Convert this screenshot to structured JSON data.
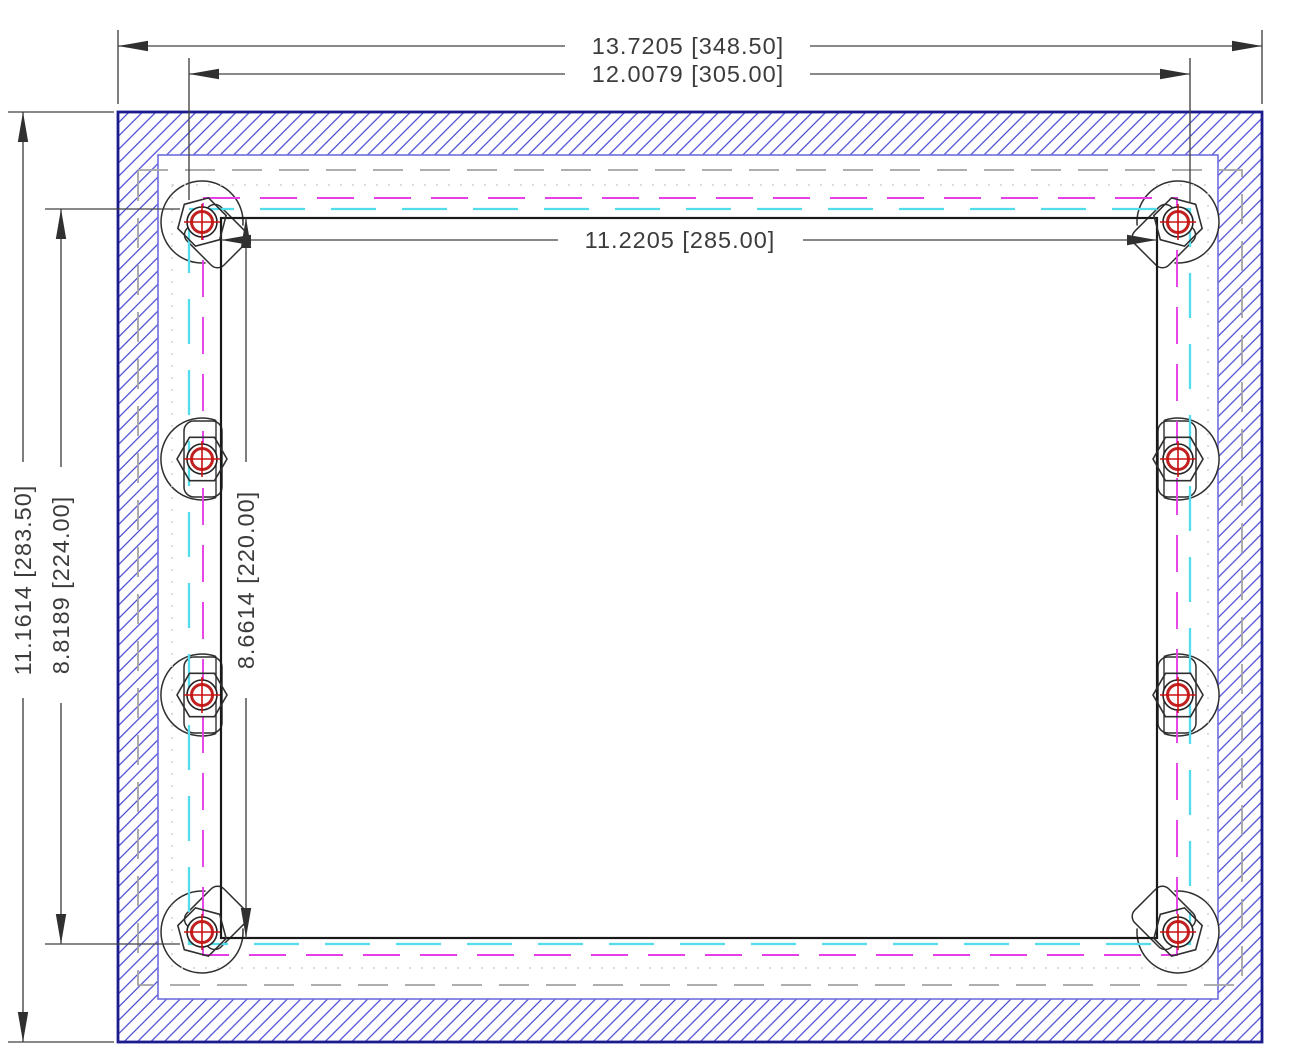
{
  "drawing": {
    "kind": "panel-mounting-cutout-cad-drawing",
    "stud_count": 8,
    "dims": {
      "overall_width": "13.7205 [348.50]",
      "mount_width": "12.0079 [305.00]",
      "opening_width": "11.2205 [285.00]",
      "overall_height": "11.1614 [283.50]",
      "mount_height": "8.8189 [224.00]",
      "opening_height": "8.6614 [220.00]"
    },
    "colors": {
      "hatch_blue": "#4a49d4",
      "outer_border_blue": "#1b1b8e",
      "inner_border_blue": "#6e6ede",
      "hidden_gray": "#a3a3a3",
      "faint_dotted_gray": "#d2d2d2",
      "magenta_dashed": "#e63ee6",
      "cyan_dashed": "#52dcec",
      "opening_black": "#191919",
      "stud_outline": "#2f2f2f",
      "stud_red": "#c02020",
      "dimension_gray": "#414141"
    }
  }
}
